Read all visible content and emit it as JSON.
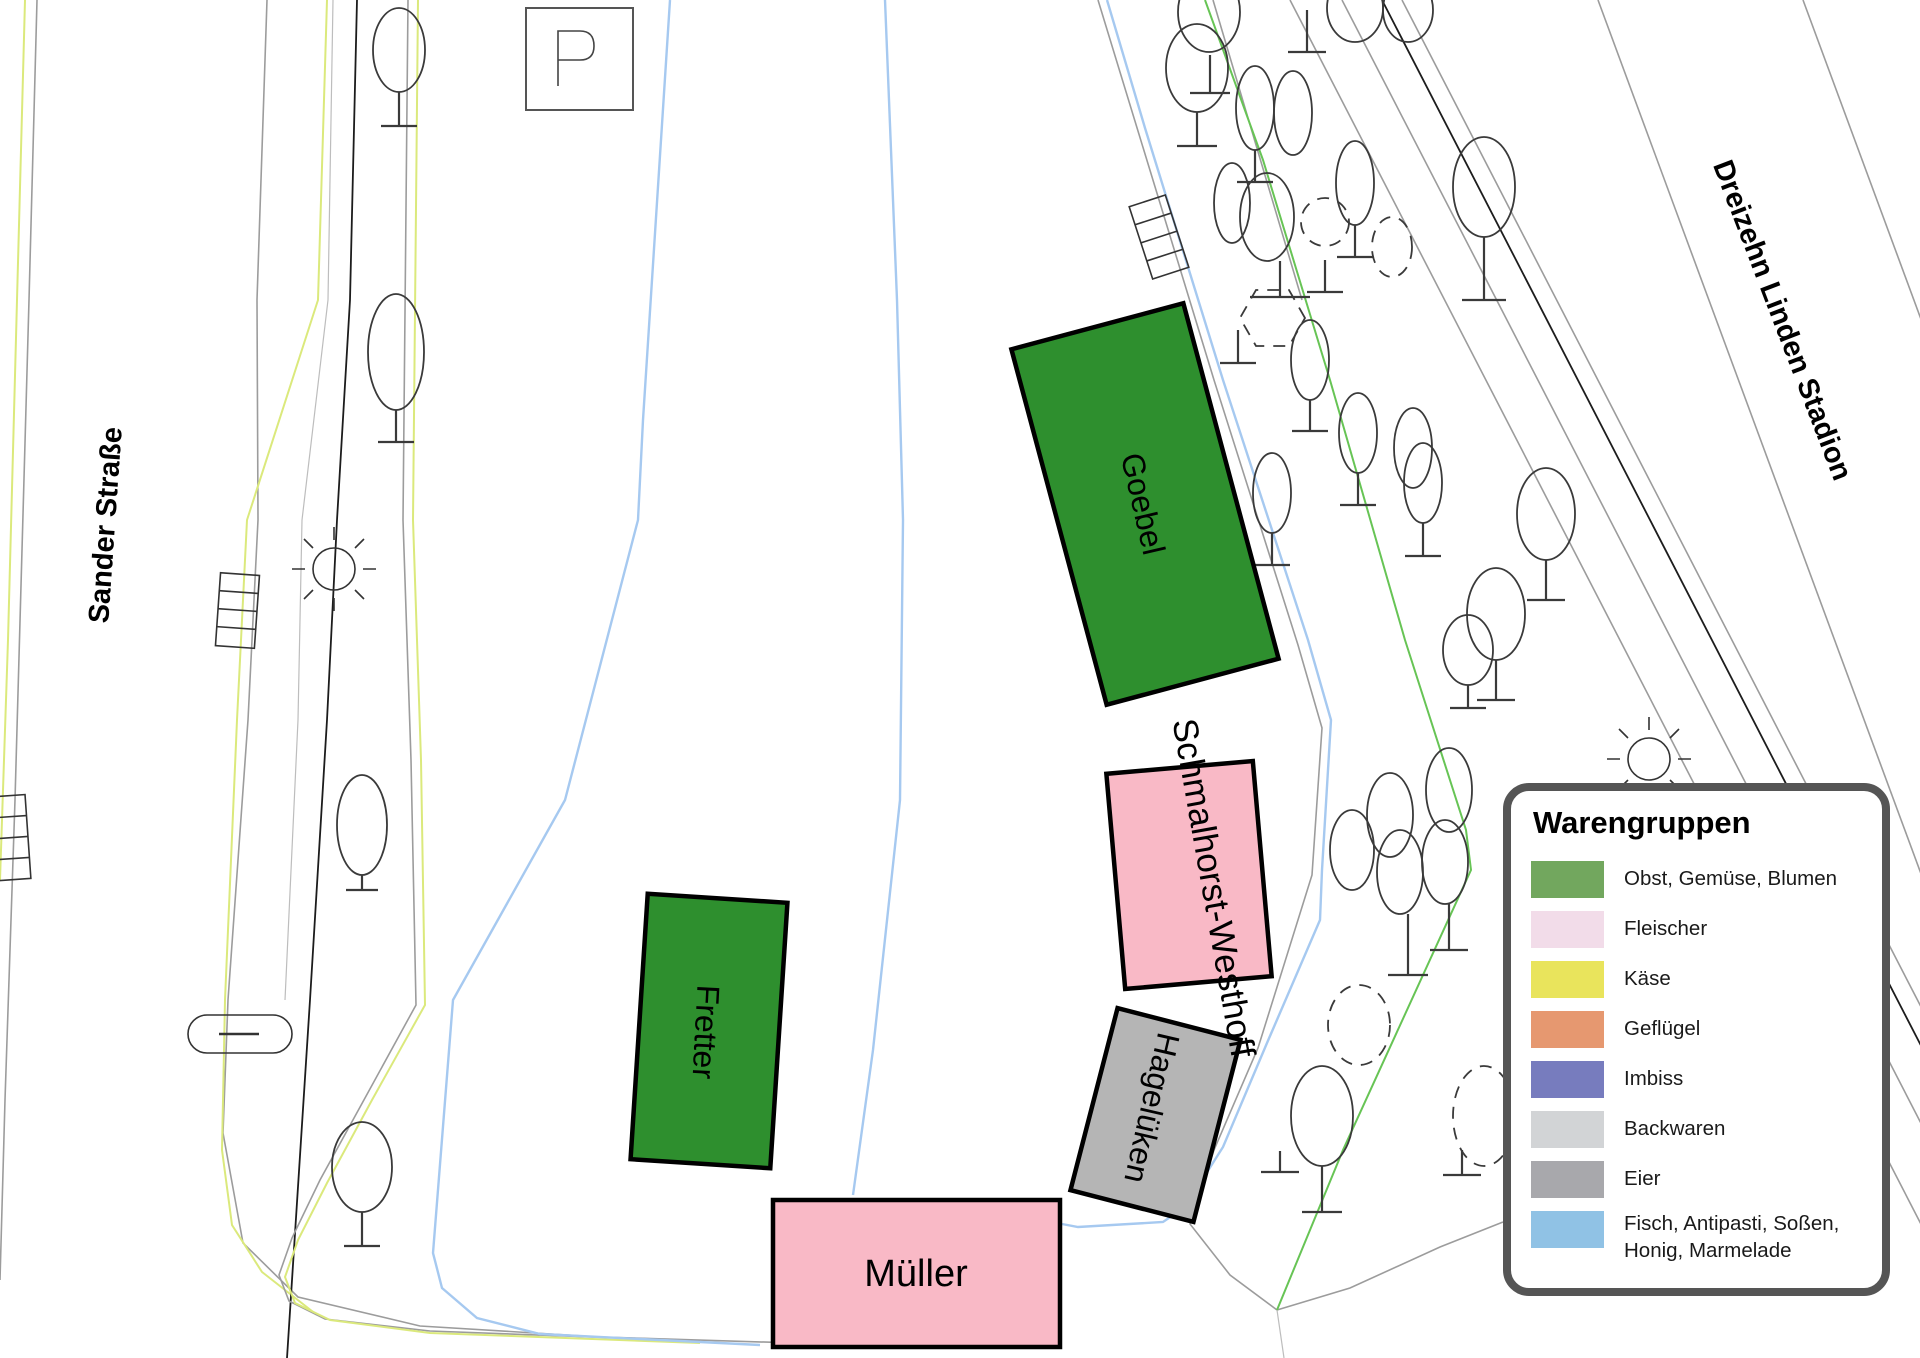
{
  "map": {
    "streets": {
      "sander": "Sander Straße",
      "stadion": "Dreizehn Linden Stadion"
    },
    "parking": {
      "label": "P"
    },
    "stalls": [
      {
        "name": "Goebel",
        "color": "#2E8F2E"
      },
      {
        "name": "Schmalhorst-Westhoff",
        "color": "#F9B9C6"
      },
      {
        "name": "Hagelüken",
        "color": "#B5B5B5"
      },
      {
        "name": "Fretter",
        "color": "#2E8F2E"
      },
      {
        "name": "Müller",
        "color": "#F9B9C6"
      }
    ]
  },
  "legend": {
    "title": "Warengruppen",
    "items": [
      {
        "label": "Obst, Gemüse, Blumen",
        "color": "#72A75E"
      },
      {
        "label": "Fleischer",
        "color": "#F2DCE9"
      },
      {
        "label": "Käse",
        "color": "#E9E45C"
      },
      {
        "label": "Geflügel",
        "color": "#E69870"
      },
      {
        "label": "Imbiss",
        "color": "#777CBE"
      },
      {
        "label": "Backwaren",
        "color": "#D2D4D6"
      },
      {
        "label": "Eier",
        "color": "#A8A8AC"
      },
      {
        "label": "Fisch, Antipasti, Soßen, Honig, Marmelade",
        "color": "#90C2E5"
      }
    ]
  }
}
